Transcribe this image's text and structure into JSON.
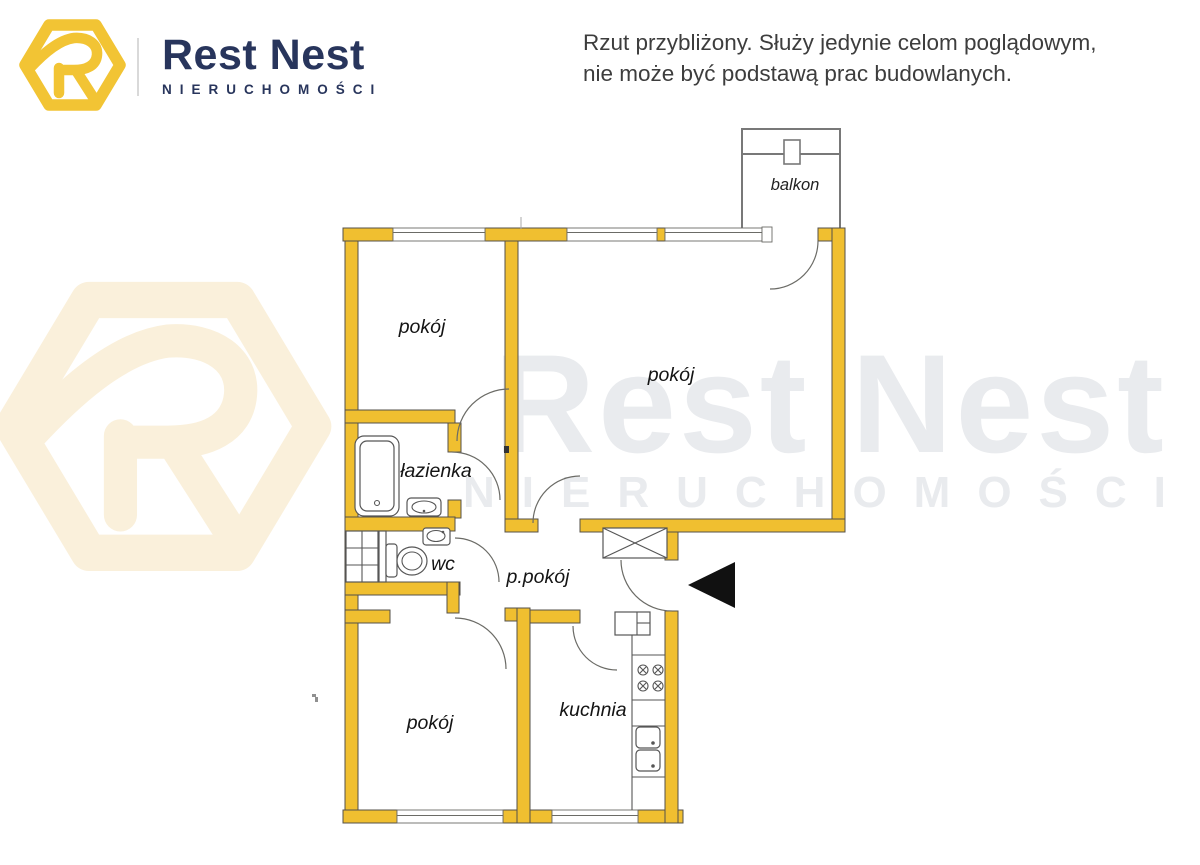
{
  "header": {
    "brand_name": "Rest Nest",
    "brand_subtitle": "NIERUCHOMOŚCI",
    "disclaimer_line1": "Rzut przybliżony. Służy jedynie celom poglądowym,",
    "disclaimer_line2": "nie może być podstawą prac budowlanych."
  },
  "watermark": {
    "brand_name": "Rest Nest",
    "brand_subtitle": "NIERUCHOMOŚCI"
  },
  "floor_plan": {
    "rooms": [
      {
        "id": "room-top-left",
        "label": "pokój"
      },
      {
        "id": "living-room",
        "label": "pokój"
      },
      {
        "id": "bathroom",
        "label": "łazienka"
      },
      {
        "id": "wc",
        "label": "wc"
      },
      {
        "id": "hallway",
        "label": "p.pokój"
      },
      {
        "id": "kitchen",
        "label": "kuchnia"
      },
      {
        "id": "room-bottom-left",
        "label": "pokój"
      },
      {
        "id": "balcony",
        "label": "balkon"
      }
    ]
  },
  "colors": {
    "wall_yellow": "#F0BF30",
    "logo_yellow": "#F2C434",
    "brand_navy": "#28355C",
    "watermark_gray": "#e9ebee",
    "watermark_cream": "#faf0db",
    "line_gray": "#6b6b66",
    "disclaimer_text": "#3d3d3d"
  }
}
